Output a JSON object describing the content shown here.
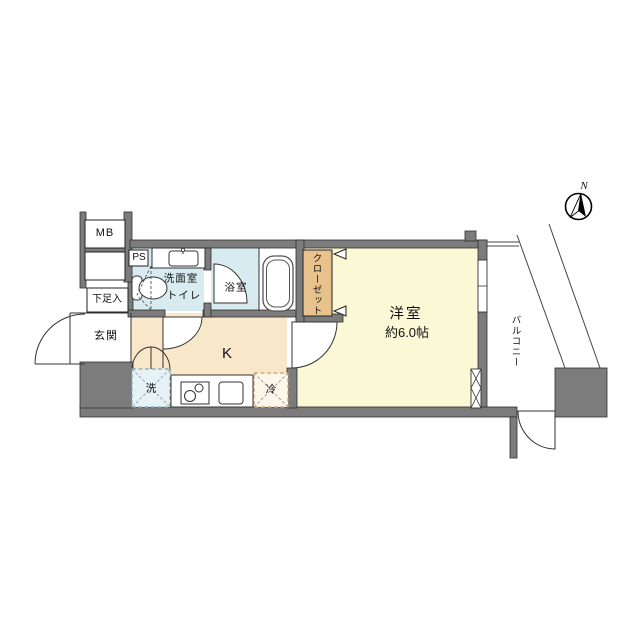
{
  "floorplan": {
    "compass": {
      "north_label": "N"
    },
    "rooms": {
      "meter_box": "MB",
      "pipe_space": "PS",
      "washroom_line1": "洗面室",
      "washroom_line2": "トイレ",
      "bathroom": "浴室",
      "closet": "クローゼット",
      "western_room_name": "洋室",
      "western_room_size": "約6.0帖",
      "kitchen": "K",
      "entrance": "玄関",
      "shoe_cabinet": "下足入",
      "washer": "洗",
      "refrigerator": "冷",
      "balcony": "バルコニー"
    },
    "colors": {
      "wall": "#7c7c7c",
      "wall_edge": "#2f2f2f",
      "wet_area": "#d7ebf0",
      "kitchen_floor": "#f9e7c9",
      "room_floor": "#fbf8d6",
      "closet_fill": "#e7c28d",
      "washer_fill": "#e7f2f6",
      "washer_dash": "#7fa8bb",
      "fridge_fill": "#fdf7ea",
      "fridge_dash": "#c79e6b",
      "line": "#333333"
    }
  }
}
